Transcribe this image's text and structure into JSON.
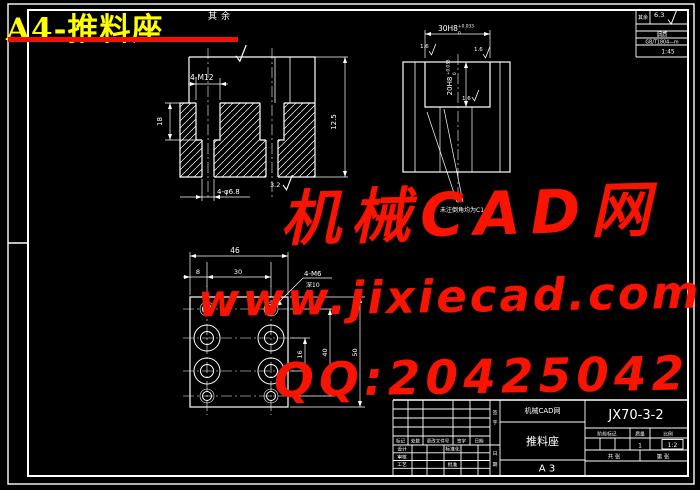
{
  "page": {
    "sheet_title": "A4-推料座",
    "accent_red": "#f81400",
    "title_yellow": "#ffff00",
    "line_color": "#ffffff"
  },
  "watermark": {
    "brand": "机械CAD网",
    "url": "www.jixiecad.com",
    "qq": "QQ:20425042"
  },
  "top_note": {
    "qiyu": "其余"
  },
  "corner_block": {
    "surface_label": "其余",
    "roughness_value": "6.3",
    "row2": "调质",
    "row3": "GB/T1804—m",
    "row4": "1:45"
  },
  "view1": {
    "dim_thread": "4-M12",
    "dim_depth": "18",
    "dim_hole": "4-φ6.8",
    "roughness": "3.2",
    "dim_height": "12.5"
  },
  "view2": {
    "dim_width": "30H8",
    "tol_up": "+0.033",
    "tol_dn": "0",
    "dim_slot": "20H8",
    "rough": "1.6",
    "note": "未注倒角均为C1"
  },
  "view3": {
    "dim_total_w": "46",
    "dim_8": "8",
    "dim_30": "30",
    "thread_note": "4-M6",
    "thread_depth": "深10",
    "dim_16": "16",
    "dim_40": "40",
    "dim_50": "50"
  },
  "title_block": {
    "drawing_no": "JX70-3-2",
    "company": "机械CAD网",
    "part_name": "推料座",
    "size": "A 3",
    "header_stage": "阶段标记",
    "header_mass": "质量",
    "header_scale": "比例",
    "value_mass": "1",
    "value_scale": "1:2",
    "sheet_total": "共 张",
    "sheet_no": "第 张",
    "rev": {
      "c1": "标记",
      "c2": "处数",
      "c3": "更改文件号",
      "c4": "签字",
      "c5": "日期"
    },
    "sig": {
      "design": "设计",
      "check": "审核",
      "process": "工艺",
      "approve": "批准",
      "standard": "标准化"
    },
    "side": {
      "s1": "签",
      "s2": "字",
      "s3": "日",
      "s4": "期"
    }
  }
}
